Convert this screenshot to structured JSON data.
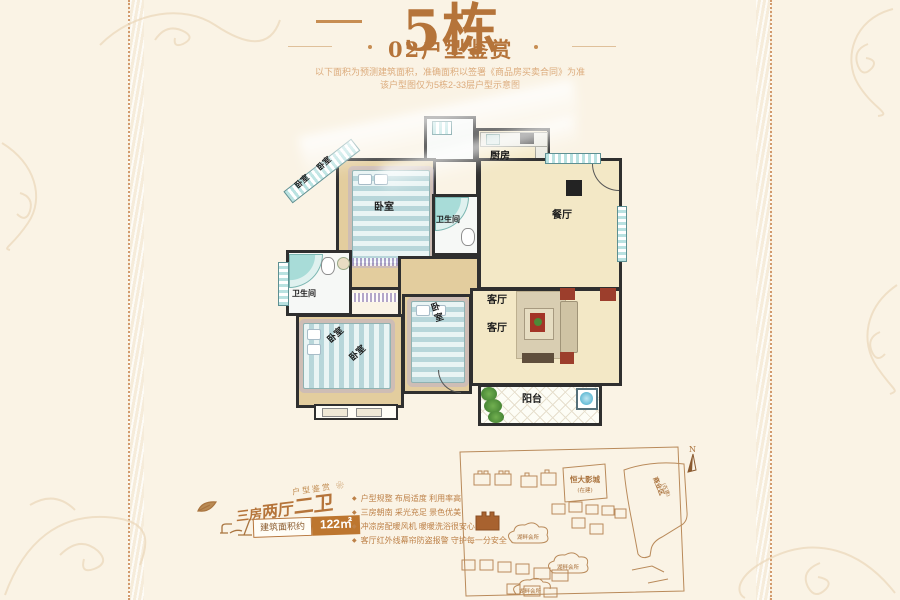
{
  "header": {
    "building_number": "5栋",
    "subtitle": "02户型鉴赏",
    "disclaimer_line1": "以下面积为预测建筑面积，准确面积以签署《商品房买卖合同》为准",
    "disclaimer_line2": "该户型图仅为5栋2-33层户型示意图"
  },
  "floorplan": {
    "kitchen": "厨房",
    "dining": "餐厅",
    "bathroom": "卫生间",
    "bedroom": "卧室",
    "living": "客厅",
    "balcony": "阳台"
  },
  "specs": {
    "tagline": "户型鉴赏 ❀",
    "layout_part1": "三房",
    "layout_part2": "两厅",
    "layout_part3": "二卫",
    "area_label": "建筑面积约",
    "area_value": "122㎡",
    "features": [
      "户型规整 布局适度 利用率高",
      "三房朝南 采光充足 景色优美",
      "冲凉房配暖风机 暖暖洗浴很安心",
      "客厅红外线幕帘防盗报警 守护每一分安全"
    ]
  },
  "sitemap": {
    "north": "N",
    "cinema": "恒大影城",
    "cinema_status": "(在建)",
    "commercial": "商业区",
    "commercial_status": "(在建)",
    "clubhouse": "湖畔会所"
  },
  "colors": {
    "accent": "#b5743a",
    "area_badge_bg": "#bd762f",
    "map_line": "#b98a5a",
    "page_bg": "#faf3e5"
  }
}
